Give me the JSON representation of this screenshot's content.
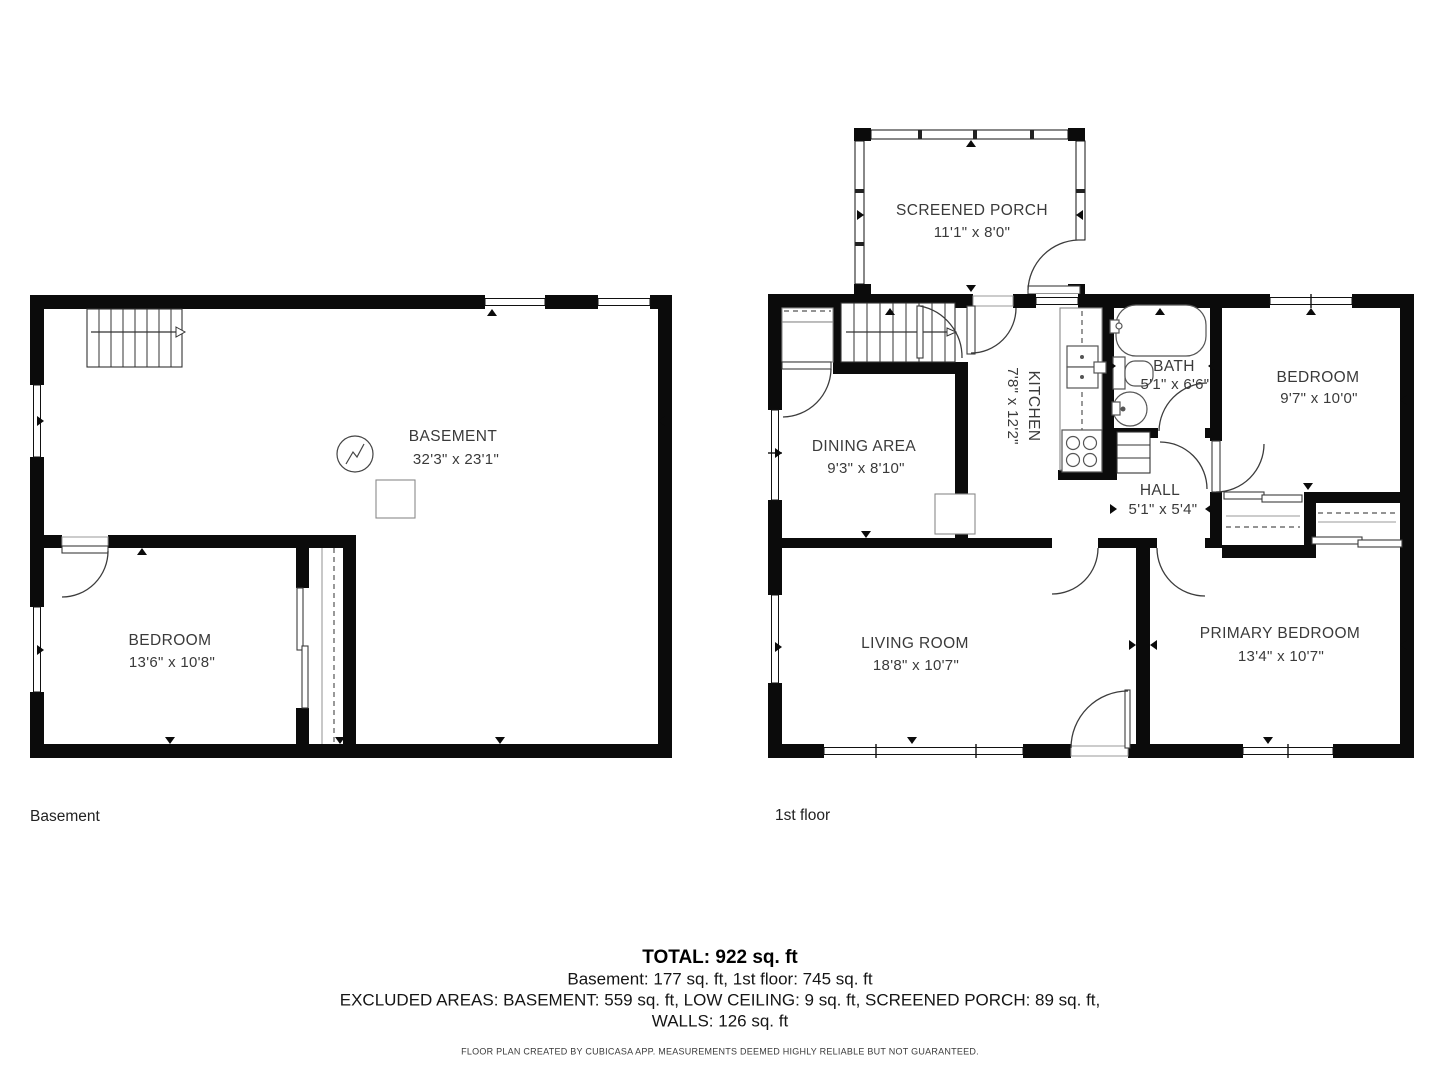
{
  "floors": {
    "basement": {
      "label": "Basement",
      "rooms": [
        {
          "name": "BASEMENT",
          "dims": "32'3\" x 23'1\""
        },
        {
          "name": "BEDROOM",
          "dims": "13'6\" x 10'8\""
        }
      ]
    },
    "first": {
      "label": "1st floor",
      "rooms": [
        {
          "name": "SCREENED PORCH",
          "dims": "11'1\" x 8'0\""
        },
        {
          "name": "DINING AREA",
          "dims": "9'3\" x 8'10\""
        },
        {
          "name": "KITCHEN",
          "dims": "7'8\" x 12'2\""
        },
        {
          "name": "BATH",
          "dims": "5'1\" x 6'6\""
        },
        {
          "name": "BEDROOM",
          "dims": "9'7\" x 10'0\""
        },
        {
          "name": "HALL",
          "dims": "5'1\" x 5'4\""
        },
        {
          "name": "LIVING ROOM",
          "dims": "18'8\" x 10'7\""
        },
        {
          "name": "PRIMARY BEDROOM",
          "dims": "13'4\" x 10'7\""
        }
      ]
    }
  },
  "summary": {
    "total": "TOTAL: 922 sq. ft",
    "floors_line": "Basement: 177 sq. ft, 1st floor: 745 sq. ft",
    "excluded_line": "EXCLUDED AREAS: BASEMENT: 559 sq. ft, LOW CEILING: 9 sq. ft, SCREENED PORCH: 89 sq. ft,",
    "walls_line": "WALLS: 126 sq. ft",
    "disclaimer": "FLOOR PLAN CREATED BY CUBICASA APP. MEASUREMENTS DEEMED HIGHLY RELIABLE BUT NOT GUARANTEED."
  }
}
